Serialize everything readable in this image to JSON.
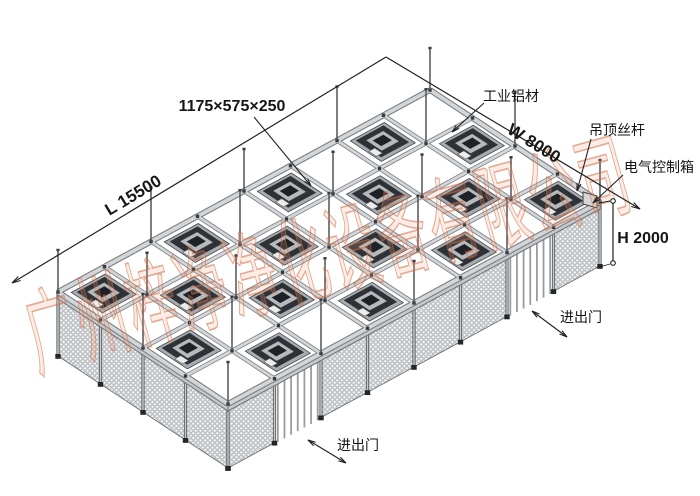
{
  "diagram": {
    "labels": {
      "ffu_size": "1175×575×250",
      "length": "L 15500",
      "width": "W 8000",
      "height": "H 2000",
      "aluminum_profile": "工业铝材",
      "ceiling_rod": "吊顶丝杆",
      "electrical_box": "电气控制箱",
      "door_right": "进出门",
      "door_bottom": "进出门"
    },
    "watermark": "广州梓净净化设备有限公司",
    "structure": {
      "grid_cells_length": 8,
      "grid_cells_width": 4,
      "ffu_count": 16,
      "door_count": 2,
      "short_wall_mesh_panels": 4,
      "long_wall_mesh_panels": 6
    },
    "colors": {
      "background": "#ffffff",
      "annotation_line": "#222222",
      "beam_core": "#d3d6d8",
      "beam_edge": "#7c7f82",
      "mesh_fill": "#c0c4c7",
      "ffu_dark": "#2e3237",
      "watermark_stroke": "#cf6a42"
    }
  }
}
